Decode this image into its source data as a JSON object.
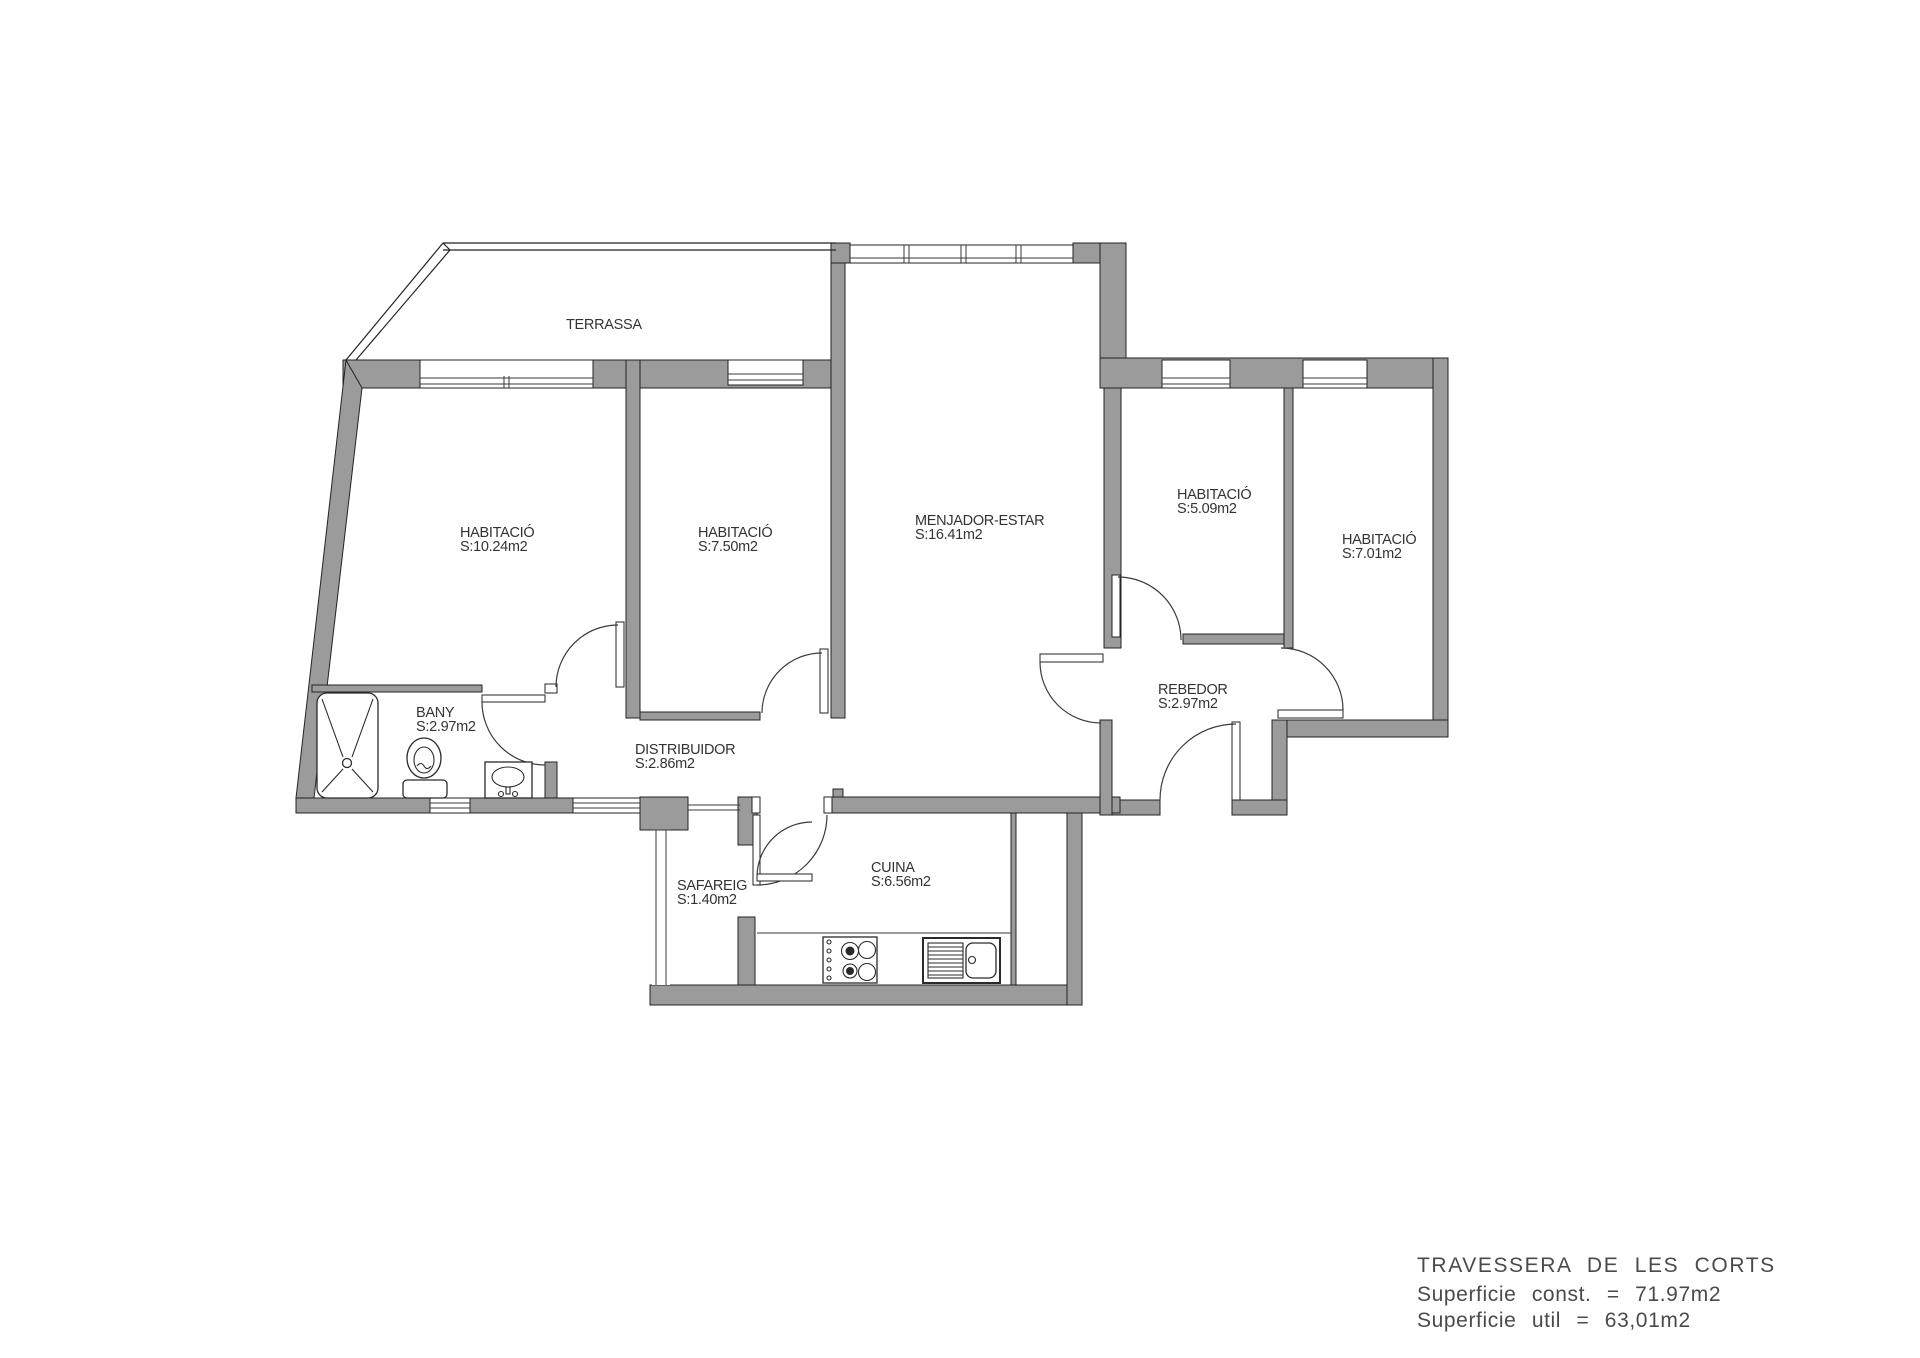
{
  "rooms": {
    "terrassa": {
      "label": "TERRASSA",
      "area": ""
    },
    "habitacio1": {
      "label": "HABITACIÓ",
      "area": "S:10.24m2"
    },
    "habitacio2": {
      "label": "HABITACIÓ",
      "area": "S:7.50m2"
    },
    "menjador": {
      "label": "MENJADOR-ESTAR",
      "area": "S:16.41m2"
    },
    "habitacio3": {
      "label": "HABITACIÓ",
      "area": "S:5.09m2"
    },
    "habitacio4": {
      "label": "HABITACIÓ",
      "area": "S:7.01m2"
    },
    "bany": {
      "label": "BANY",
      "area": "S:2.97m2"
    },
    "distribuidor": {
      "label": "DISTRIBUIDOR",
      "area": "S:2.86m2"
    },
    "rebedor": {
      "label": "REBEDOR",
      "area": "S:2.97m2"
    },
    "safareig": {
      "label": "SAFAREIG",
      "area": "S:1.40m2"
    },
    "cuina": {
      "label": "CUINA",
      "area": "S:6.56m2"
    }
  },
  "title_block": {
    "street": "TRAVESSERA DE LES CORTS",
    "surface_built": "Superficie const. = 71.97m2",
    "surface_usable": "Superficie util = 63,01m2"
  },
  "colors": {
    "wall": "#9b9b9b",
    "line": "#232323",
    "text": "#333333"
  }
}
